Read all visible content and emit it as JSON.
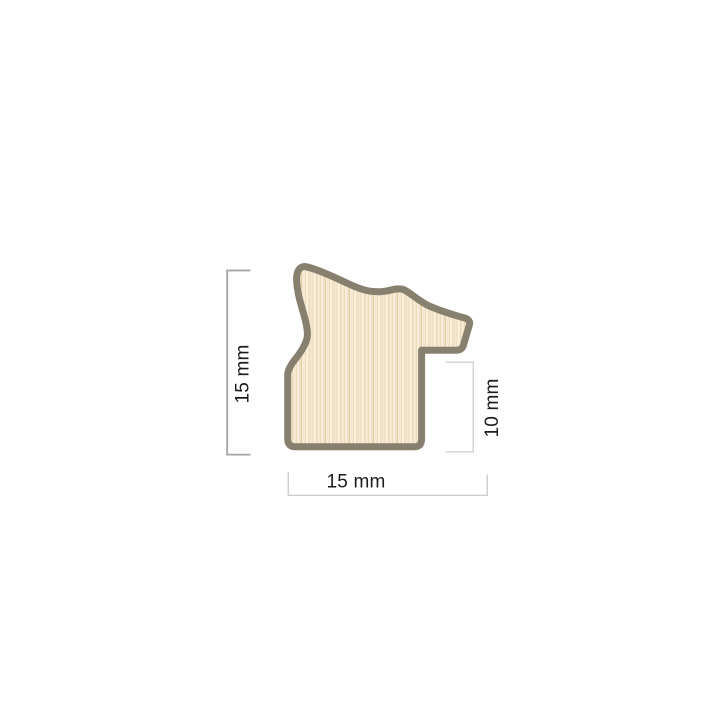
{
  "page": {
    "background": "#ffffff"
  },
  "diagram": {
    "title": "frame-moulding-profile-cross-section",
    "outline_color": "#87806f",
    "label_color": "#1b1b1b",
    "dimension_line_colors": {
      "left": "#a3a3a3",
      "right": "#d3d3d3",
      "bottom": "#cdcdcd"
    },
    "dimensions": [
      {
        "id": "profile-height",
        "label": "15 mm",
        "orientation": "vertical",
        "position": "left"
      },
      {
        "id": "rebate-height",
        "label": "10 mm",
        "orientation": "vertical",
        "position": "right"
      },
      {
        "id": "profile-width",
        "label": "15 mm",
        "orientation": "horizontal",
        "position": "bottom"
      }
    ]
  },
  "wood": {
    "base": "#f3e5cb",
    "stripes": [
      {
        "x": 0,
        "w": 2,
        "c": "#f2e3c8"
      },
      {
        "x": 2,
        "w": 2,
        "c": "#f9f0df"
      },
      {
        "x": 4,
        "w": 1,
        "c": "#e8d3ad"
      },
      {
        "x": 5,
        "w": 3,
        "c": "#f5e8d1"
      },
      {
        "x": 8,
        "w": 1,
        "c": "#ecd9b6"
      },
      {
        "x": 9,
        "w": 2,
        "c": "#f8eedd"
      },
      {
        "x": 11,
        "w": 2,
        "c": "#efdec1"
      },
      {
        "x": 13,
        "w": 1,
        "c": "#e5cfa5"
      },
      {
        "x": 14,
        "w": 3,
        "c": "#f6ead6"
      },
      {
        "x": 17,
        "w": 1,
        "c": "#ebd7b2"
      },
      {
        "x": 18,
        "w": 2,
        "c": "#f9f0e0"
      },
      {
        "x": 20,
        "w": 2,
        "c": "#f0e0c4"
      },
      {
        "x": 22,
        "w": 2,
        "c": "#f4e6cd"
      }
    ]
  }
}
